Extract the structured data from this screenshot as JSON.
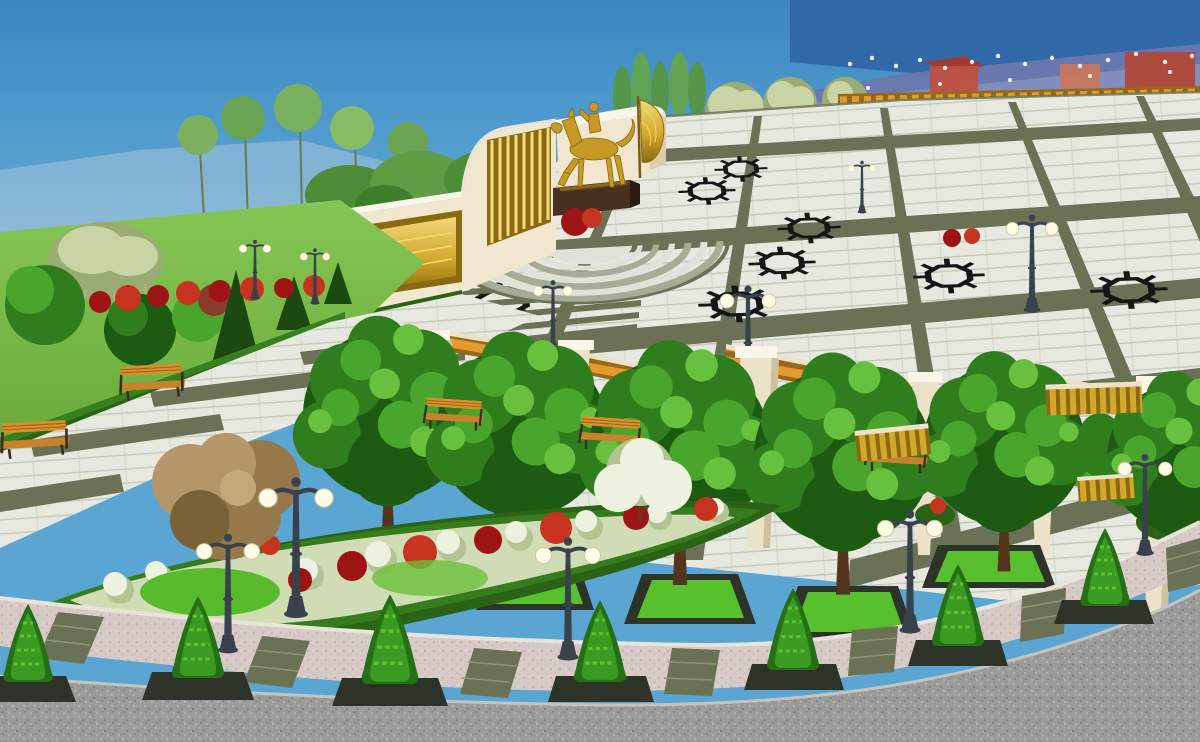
{
  "image": {
    "kind": "3d-architectural-visualization",
    "subject": "public memorial park plaza with gilded equestrian monument",
    "style": "daytime rendering, elevated three-quarter view",
    "visible_text": "none",
    "width_px": 1200,
    "height_px": 742
  },
  "palette": {
    "skyTop": "#3c86c2",
    "skyMid": "#5aa5d2",
    "skyLow": "#8fc3de",
    "skyRight": "#2b5c9e",
    "mountain": "#6c78ae",
    "mountainLight": "#8c97c2",
    "haze": "#a9c3d8",
    "lawn": "#69aa3c",
    "lawnLight": "#86c653",
    "lawnDark": "#4e8a2c",
    "tile": "#e7e8e0",
    "tileLine": "#bcc2ae",
    "band": "#6a7154",
    "bandDark": "#555c42",
    "star": "#161616",
    "cream": "#f1e6cf",
    "creamShadow": "#d9c6a3",
    "white": "#faf5e9",
    "gold": "#d4a82c",
    "goldLight": "#f2d878",
    "goldDark": "#8a6a10",
    "statueGold": "#c79a25",
    "pedestal": "#46301f",
    "pedestalDark": "#2a1c11",
    "treeDark": "#1d5a12",
    "treeMid": "#2f7d1c",
    "treeLight": "#4aa52c",
    "treeXL": "#68c13e",
    "paleTree": "#c9d4a4",
    "paleTreeDark": "#9aab74",
    "hedge": "#2a6316",
    "hedgeLight": "#3f8c22",
    "planterRim": "#2e332a",
    "planterGrass": "#57c02c",
    "redShrub": "#9e1414",
    "redShrubLight": "#c63420",
    "whiteShrub": "#edf2e0",
    "whiteShrubShadow": "#b3c492",
    "pillar": "#ece2c8",
    "pillarShadow": "#cfc1a0",
    "wood": "#e49a2c",
    "woodDark": "#96691a",
    "bench": "#d8902c",
    "lampPole": "#39414d",
    "lampGlobe": "#fffbe6",
    "sidewalk": "#d7cac6",
    "sidewalkDot": "#c2b2ae",
    "strip": "#6a7154",
    "road": "#9b9b99",
    "roadLight": "#b2b2b0",
    "roadDark": "#7e7e7c",
    "stepsLight": "#e0e1d8",
    "stepsMid": "#a6ac96",
    "curb": "#e9e4da",
    "brown": "#96784a",
    "brownLight": "#b49668",
    "brownDark": "#7a6238",
    "pathGray": "#cfcfc2"
  },
  "scene": {
    "sky": {
      "condition": "clear",
      "right_horizon": "darker dusk blue with distant mountains"
    },
    "background": {
      "mountains": "hazy blue-violet ridge on the right half",
      "tree_line": "poplars, pale olive trees and round green trees along the horizon",
      "colonnade": {
        "pillar_count": 6,
        "beam": "golden timber beam with garland",
        "string_lights": true,
        "buildings": "small red-roofed pavilions behind"
      }
    },
    "monument": {
      "wall": "curved cream memorial wall",
      "gold_relief_panel": "long recessed gilded panel on left wall section",
      "gold_screen": "vertical gilded slat screen on tall center section",
      "statue": {
        "subject": "equestrian rider",
        "material": "gilded",
        "pose": "horse stepping, rider facing left"
      },
      "pedestal": "dark brown stone plinth",
      "banner": "gilded flag beside the statue",
      "steps": {
        "shape": "semicircular fan",
        "rings": 6
      }
    },
    "plaza": {
      "paving": "light granite tile squares",
      "grid_bands": "dark olive granite bands in two perspective directions",
      "star_motifs": {
        "shape": "eight-pointed star outline",
        "color": "black",
        "count": 8
      },
      "stripe_zones": 3
    },
    "pergolas": {
      "count": 3,
      "pillars": "tapered cream columns with white caps",
      "roof": "golden timber slats"
    },
    "trees": {
      "boulevard_trees": {
        "count": 6,
        "type": "round deciduous",
        "in_planters": true,
        "planter": "dark rim with bright lawn"
      },
      "conical_shrubs": {
        "count": 7,
        "location": "along bottom sidewalk in dark planters"
      },
      "garden_trees": "mixed green trees, dark conifers, pale willow, copper-leaf tree, white blossom tree"
    },
    "furniture": {
      "benches": {
        "count": 5,
        "material": "orange wood slats, dark metal frames"
      },
      "gold_slat_screens": {
        "count": 3
      }
    },
    "lighting": {
      "double_globe_lamps": {
        "count": 11,
        "pole": "dark cast iron",
        "globes": "white spheres"
      }
    },
    "flower_bed": {
      "shape": "long curved lens bordered by clipped hedge",
      "plants": [
        "white shrubs",
        "red shrubs",
        "bright lawn patches"
      ]
    },
    "circulation": {
      "promenade": "diagonal walkway with wide olive inlay strips",
      "sidewalk": {
        "surface": "pink-grey pavers",
        "olive_inlay_strips": 7
      },
      "road": "curved grey asphalt at the bottom edge"
    }
  }
}
